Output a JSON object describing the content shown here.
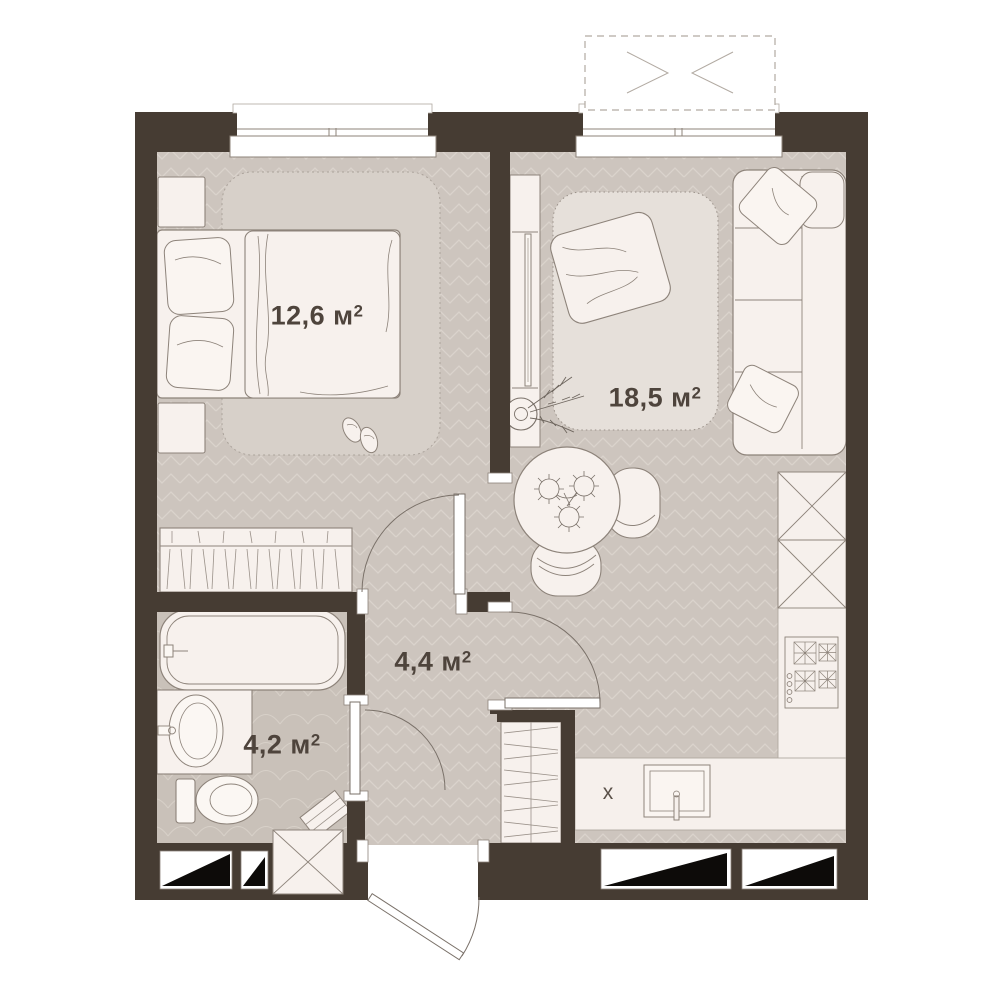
{
  "plan": {
    "type": "apartment-floor-plan",
    "rooms": [
      {
        "id": "bedroom",
        "area": "12,6 м",
        "sup": "2"
      },
      {
        "id": "living-kitchen",
        "area": "18,5 м",
        "sup": "2"
      },
      {
        "id": "hallway",
        "area": "4,4 м",
        "sup": "2"
      },
      {
        "id": "bathroom",
        "area": "4,2 м",
        "sup": "2"
      }
    ],
    "marks": {
      "sink_unit": "х"
    },
    "colors": {
      "wall": "#463c33",
      "floor": "#cdc5be",
      "floor_line": "#dad3cc",
      "bath_floor": "#c9c1b9",
      "furniture": "#f7f1ed",
      "outline": "#8d837a",
      "label": "#4e443c",
      "vent_fill": "#0d0b09"
    },
    "fixtures": {
      "bedroom": [
        "double-bed",
        "pillows",
        "duvet",
        "nightstand",
        "nightstand",
        "rug",
        "wardrobe",
        "slippers",
        "window"
      ],
      "living_kitchen": [
        "corner-sofa",
        "sofa-pillows",
        "rug",
        "throw-blanket",
        "tv-console",
        "tv",
        "plant",
        "round-dining-table",
        "flower-bouquet",
        "chair",
        "chair",
        "tall-cabinets",
        "stove",
        "kitchen-sink",
        "counter",
        "window",
        "balcony"
      ],
      "hallway": [
        "closet",
        "entry-door"
      ],
      "bathroom": [
        "bathtub",
        "washbasin",
        "toilet",
        "washing-machine",
        "bath-mat"
      ]
    }
  }
}
